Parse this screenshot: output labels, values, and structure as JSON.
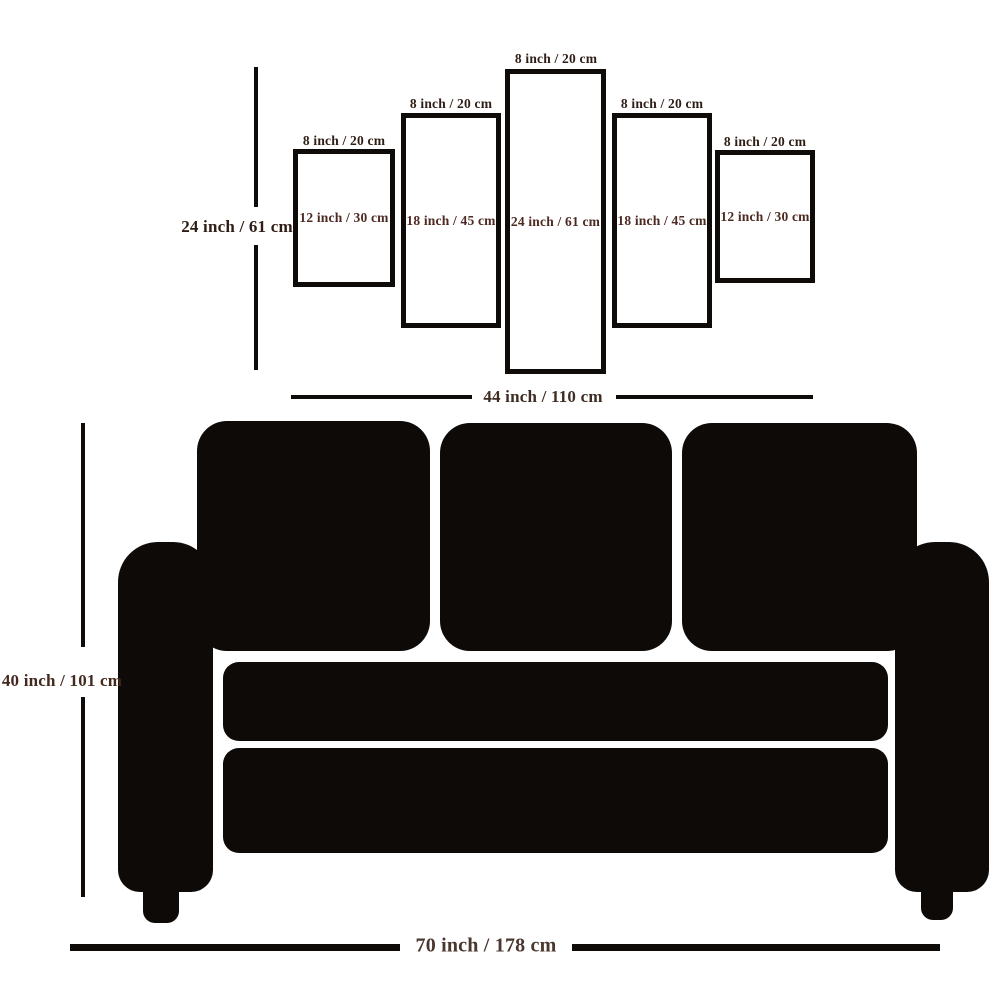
{
  "diagram_title": "canvas-panel-size-guide",
  "colors": {
    "ink": "#0f0b08",
    "label_dark": "#2e1d15",
    "label_maroon": "#4d2a22",
    "label_brown": "#4a372f",
    "background": "#ffffff"
  },
  "panels": [
    {
      "name": "panel-1",
      "top_label": "8 inch / 20 cm",
      "size_label": "12 inch / 30 cm"
    },
    {
      "name": "panel-2",
      "top_label": "8 inch / 20 cm",
      "size_label": "18 inch / 45 cm"
    },
    {
      "name": "panel-3",
      "top_label": "8 inch / 20 cm",
      "size_label": "24 inch / 61 cm"
    },
    {
      "name": "panel-4",
      "top_label": "8 inch / 20 cm",
      "size_label": "18 inch / 45 cm"
    },
    {
      "name": "panel-5",
      "top_label": "8 inch / 20 cm",
      "size_label": "12 inch / 30 cm"
    }
  ],
  "dimensions": {
    "panel_set_height": "24 inch / 61 cm",
    "panel_set_width": "44 inch / 110 cm",
    "sofa_height": "40 inch / 101 cm",
    "sofa_width": "70 inch / 178 cm"
  }
}
